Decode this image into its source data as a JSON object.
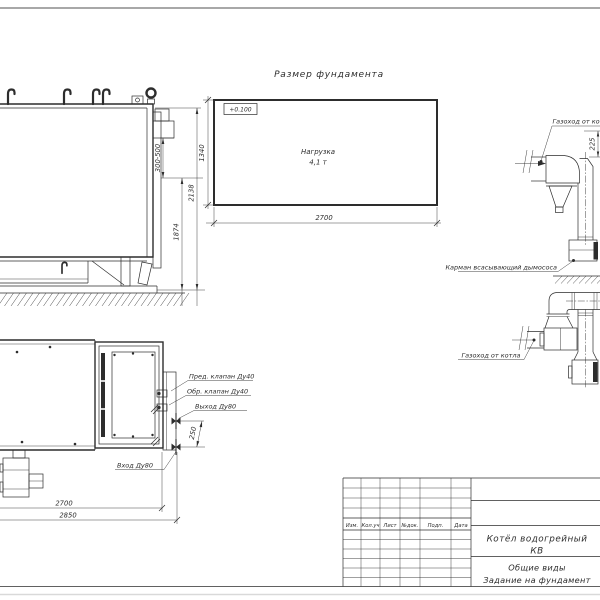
{
  "foundation_plan": {
    "title": "Размер фундамента",
    "elevation_mark": "+0.100",
    "load_label": "Нагрузка",
    "load_value": "4,1 т",
    "dim_length": "2700",
    "dim_width": "1340"
  },
  "side_view": {
    "dim_flue_height_range": "300-500",
    "dim_height_to_flue": "1874",
    "dim_total_height": "2138"
  },
  "plan_view": {
    "label_safety_valve": "Пред. клапан Ду40",
    "label_check_valve": "Обр. клапан Ду40",
    "label_outlet": "Выход Ду80",
    "label_inlet": "Вход Ду80",
    "dim_nozzle_spacing": "250",
    "dim_body_length": "2700",
    "dim_overall_length": "2850"
  },
  "flue_top_detail": {
    "label_flue": "Газоход от котла",
    "label_pocket": "Карман всасывающий дымососа",
    "dim_flue": "225"
  },
  "flue_bottom_detail": {
    "label_flue": "Газоход от котла"
  },
  "title_block": {
    "headers": [
      "Изм.",
      "Кол.уч",
      "Лист",
      "№док.",
      "Подп.",
      "Дата"
    ],
    "product_line1": "Котёл водогрейный",
    "product_line2": "КВ",
    "doc_line1": "Общие виды",
    "doc_line2": "Задание на фундамент"
  }
}
